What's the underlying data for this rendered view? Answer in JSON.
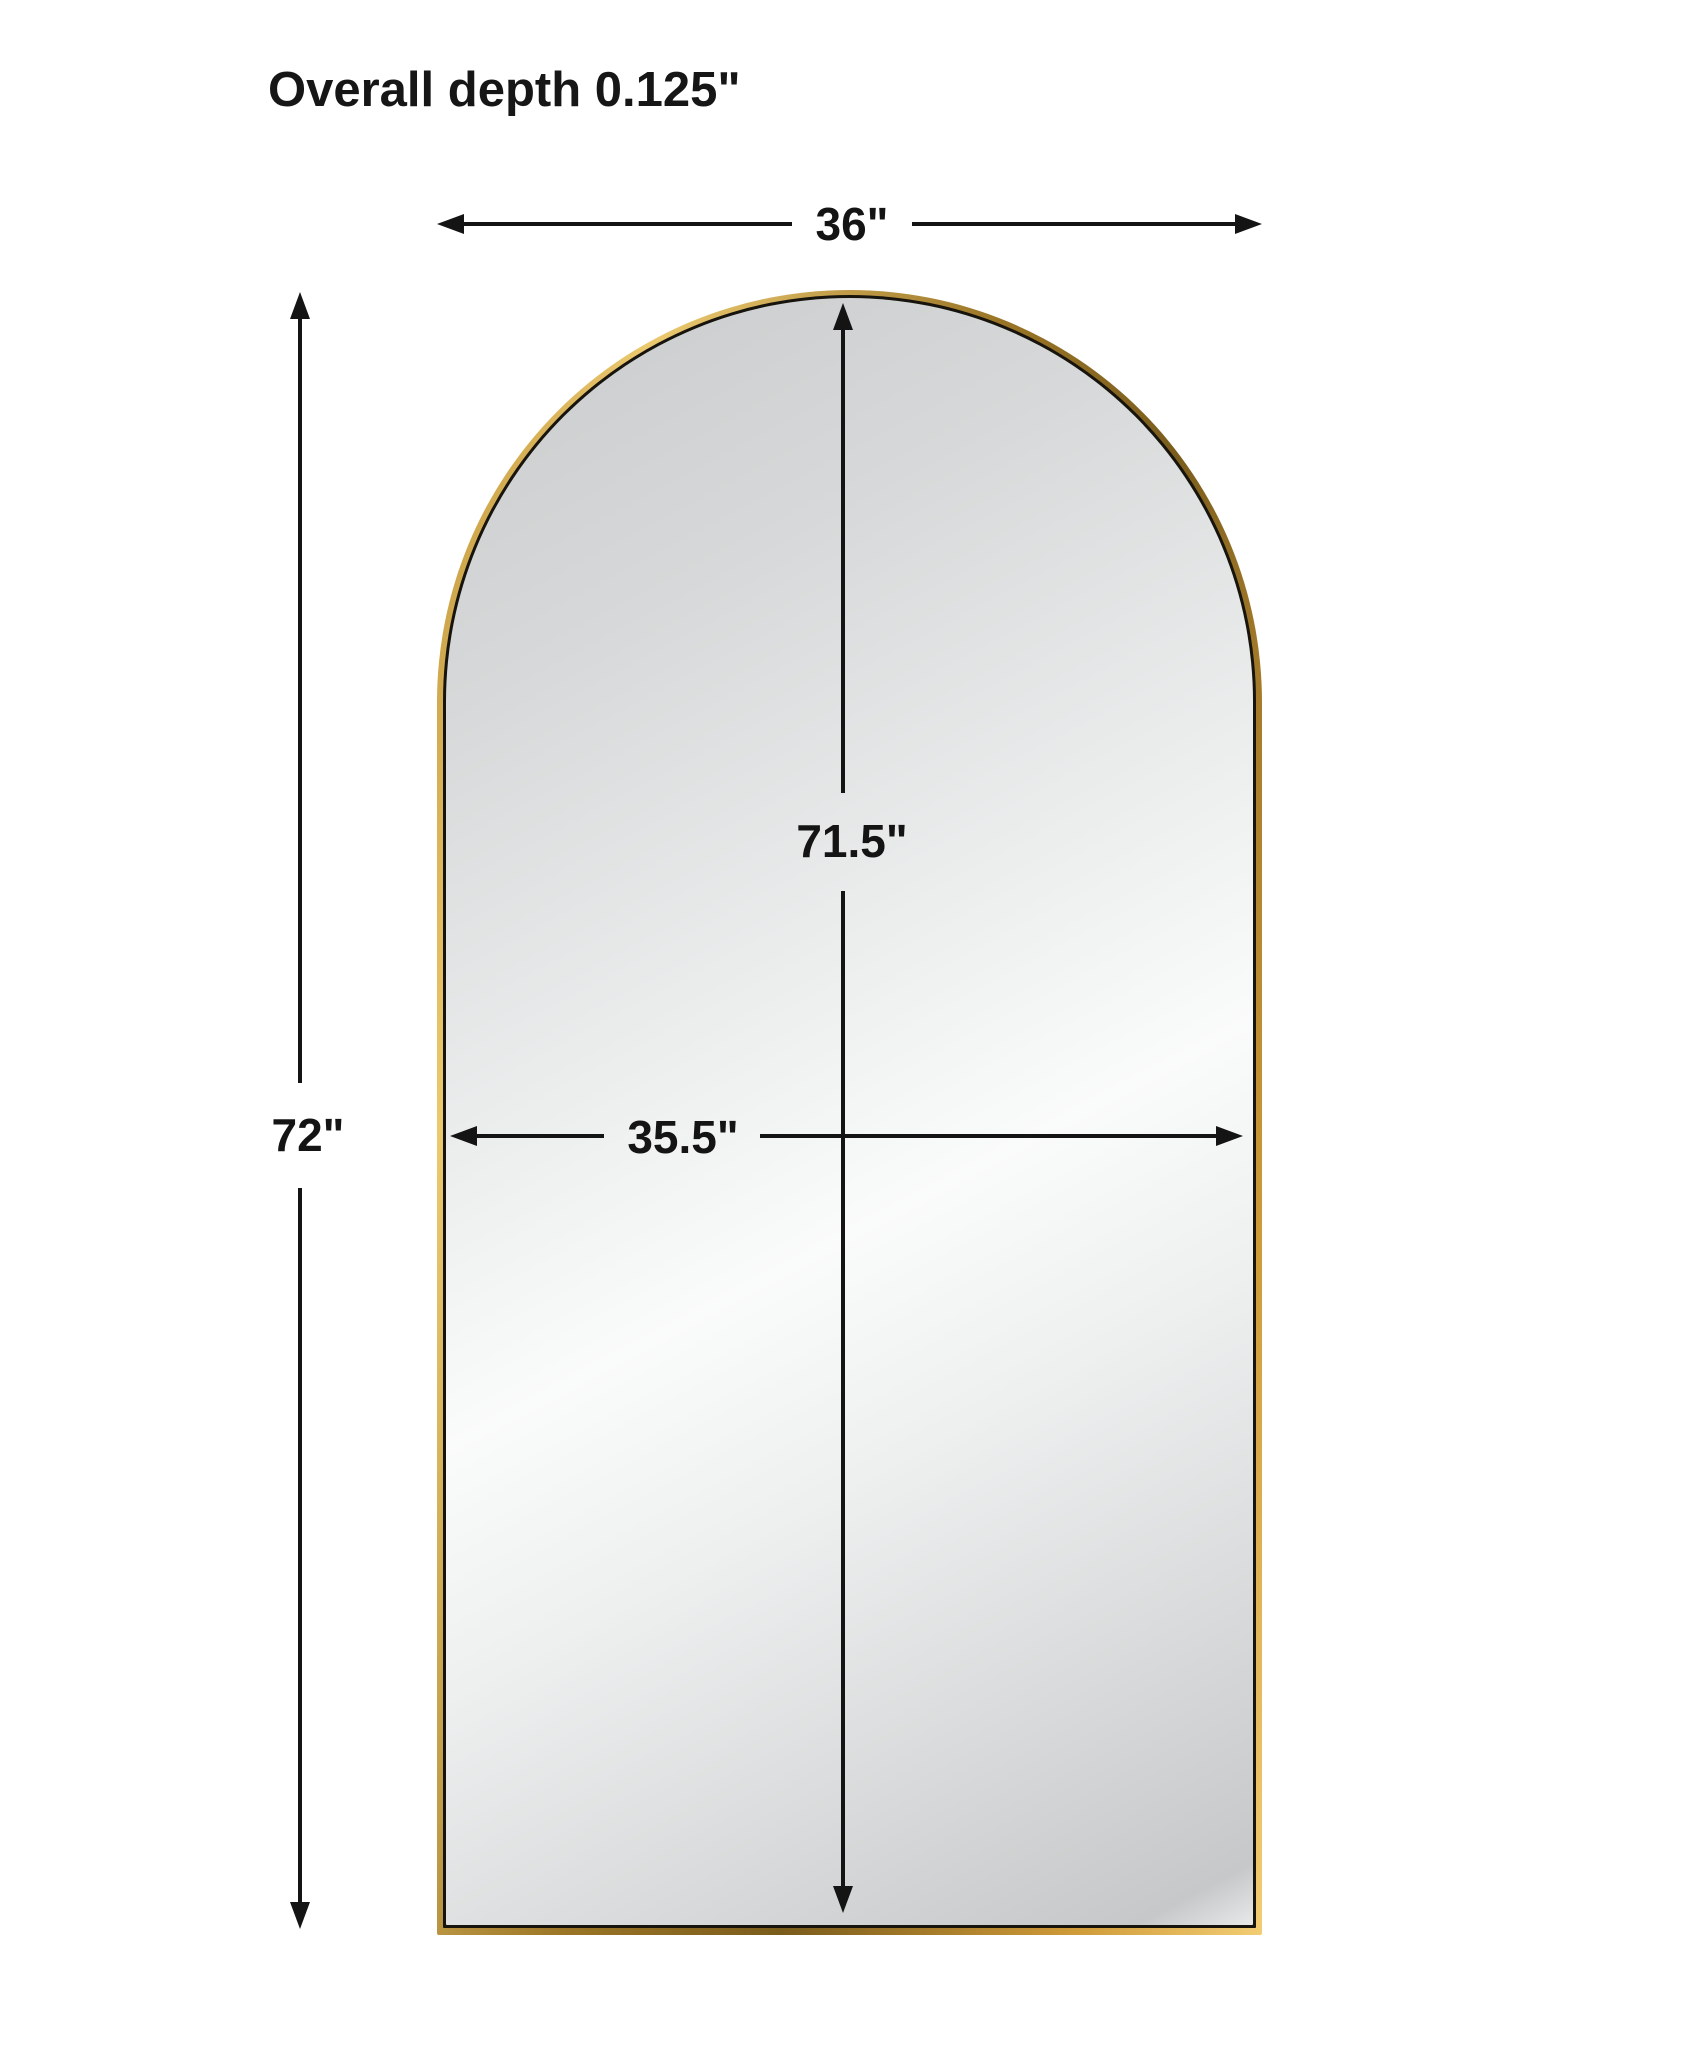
{
  "heading": {
    "text": "Overall depth 0.125\""
  },
  "mirror": {
    "type": "arched full-length mirror",
    "frame_finish": "gold",
    "frame_color": "#cf9a38",
    "frame_inner_line_color": "#17140e",
    "glass_color": "#d9dbdc"
  },
  "dimensions": {
    "overall_depth": {
      "label": "0.125\""
    },
    "overall_width": {
      "label": "36\""
    },
    "overall_height": {
      "label": "72\""
    },
    "mirror_height": {
      "label": "71.5\""
    },
    "mirror_width": {
      "label": "35.5\""
    }
  }
}
